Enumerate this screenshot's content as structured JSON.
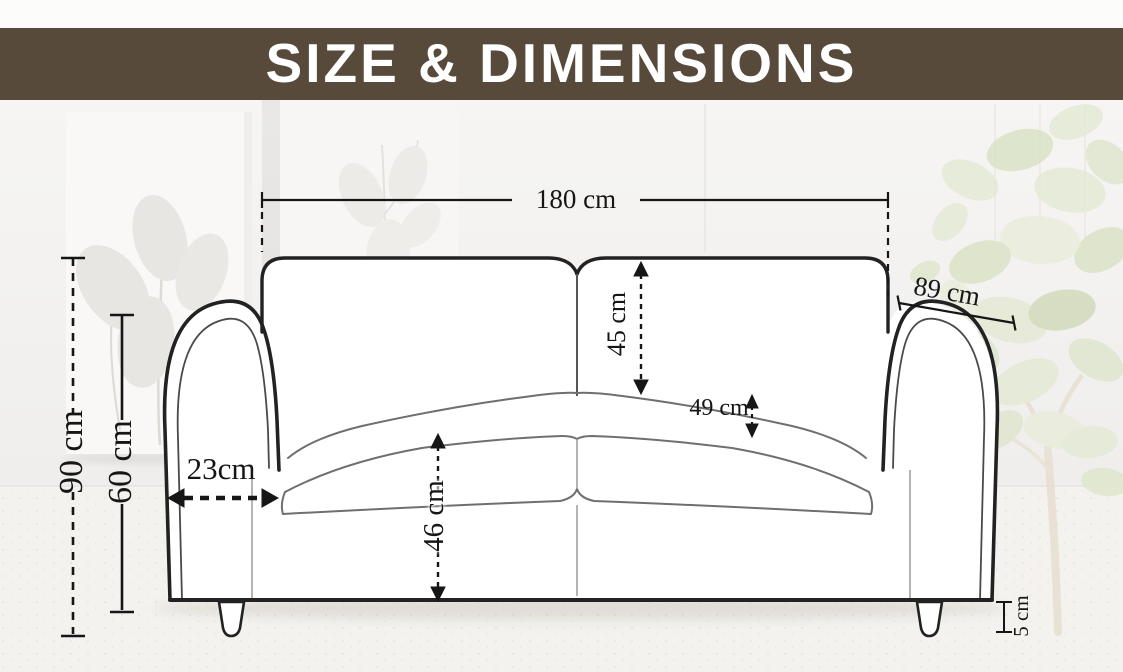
{
  "header": {
    "title": "SIZE & DIMENSIONS",
    "band_color": "#574a3a",
    "text_color": "#ffffff"
  },
  "dimensions": {
    "overall_width": {
      "label": "180 cm"
    },
    "seat_depth": {
      "label": "89 cm"
    },
    "overall_height": {
      "label": "90 cm"
    },
    "arm_height": {
      "label": "60 cm"
    },
    "arm_width": {
      "label": "23cm"
    },
    "back_cushion_height": {
      "label": "45 cm"
    },
    "seat_cushion_thickness": {
      "label": "49 cm"
    },
    "seat_front_height": {
      "label": "46 cm"
    },
    "leg_height": {
      "label": "5 cm"
    }
  },
  "illustration": {
    "line_color": "#222222",
    "seam_color": "#777777",
    "plant_green": "#d9e1c4"
  }
}
